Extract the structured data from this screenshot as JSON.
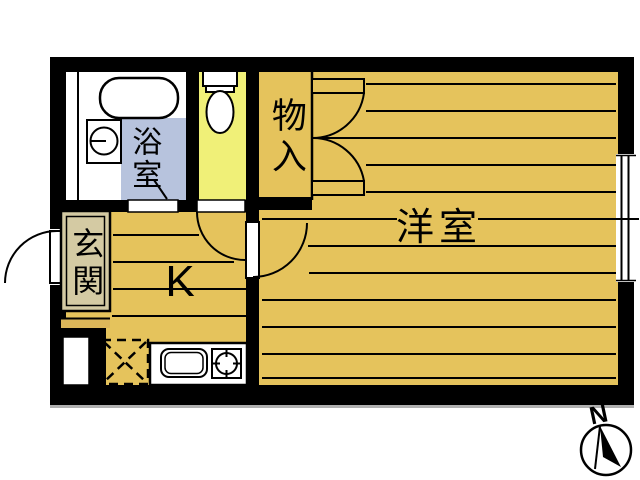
{
  "labels": {
    "bathroom": "浴室",
    "closet": "物入",
    "western_room": "洋室",
    "entrance": "玄関",
    "kitchen": "K",
    "compass_north": "N"
  },
  "colors": {
    "floor": "#e5c35c",
    "bathroom_floor": "#b7c3dd",
    "toilet_floor": "#f0f078",
    "entrance_floor": "#d4caa3",
    "entrance_step": "#dcb75a",
    "wall": "#000000",
    "fixture_fill": "#ffffff",
    "background": "#ffffff"
  },
  "fixtures": [
    "bathtub",
    "washing-machine",
    "toilet",
    "kitchen-sink",
    "gas-stove",
    "refrigerator-space",
    "pipe-space",
    "entrance-door",
    "bathroom-door",
    "toilet-door",
    "room-door",
    "closet-double-door",
    "window"
  ]
}
